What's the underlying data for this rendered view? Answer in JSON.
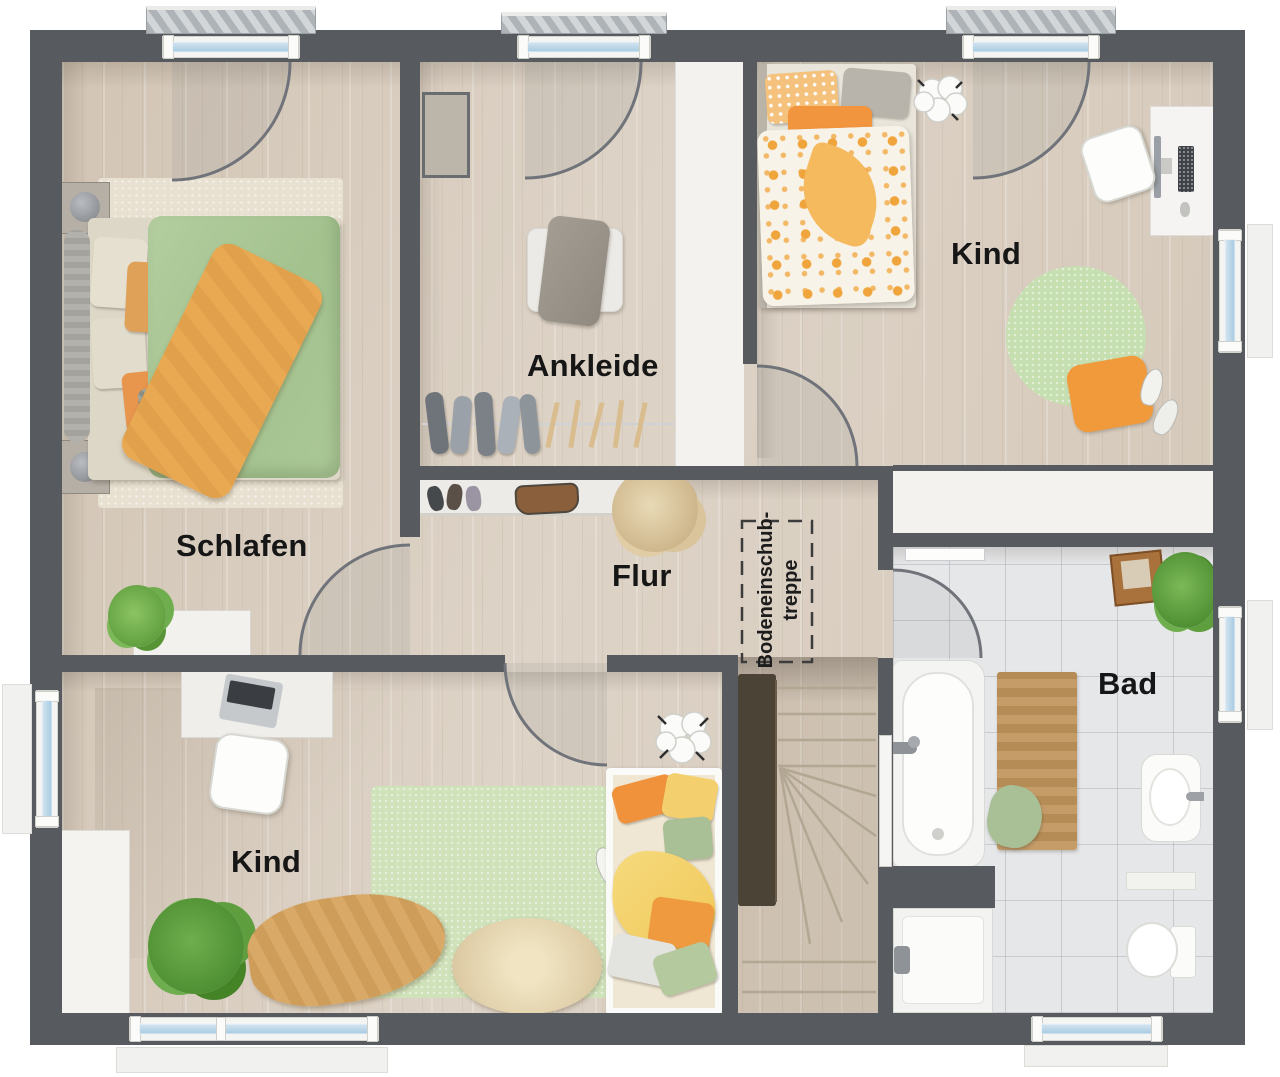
{
  "plan": {
    "type": "floor-plan",
    "floor": "upper-floor",
    "rooms": {
      "schlafen": {
        "label": "Schlafen"
      },
      "ankleide": {
        "label": "Ankleide"
      },
      "kind_top": {
        "label": "Kind"
      },
      "flur": {
        "label": "Flur"
      },
      "kind_bottom": {
        "label": "Kind"
      },
      "bad": {
        "label": "Bad"
      },
      "bodeneinschubtreppe": {
        "label_line1": "Bodeneinschub-",
        "label_line2": "treppe"
      }
    },
    "colors": {
      "wall": "#575b60",
      "wood_floor": "#d9cec0",
      "bath_tile": "#e6e7e9",
      "window_glass": "#b9d4e8",
      "accent_orange": "#f09a3c",
      "accent_green": "#a9c795",
      "rug_green": "#cfe2ba",
      "stair_railing": "#4b4335",
      "label_text": "#161616"
    }
  }
}
